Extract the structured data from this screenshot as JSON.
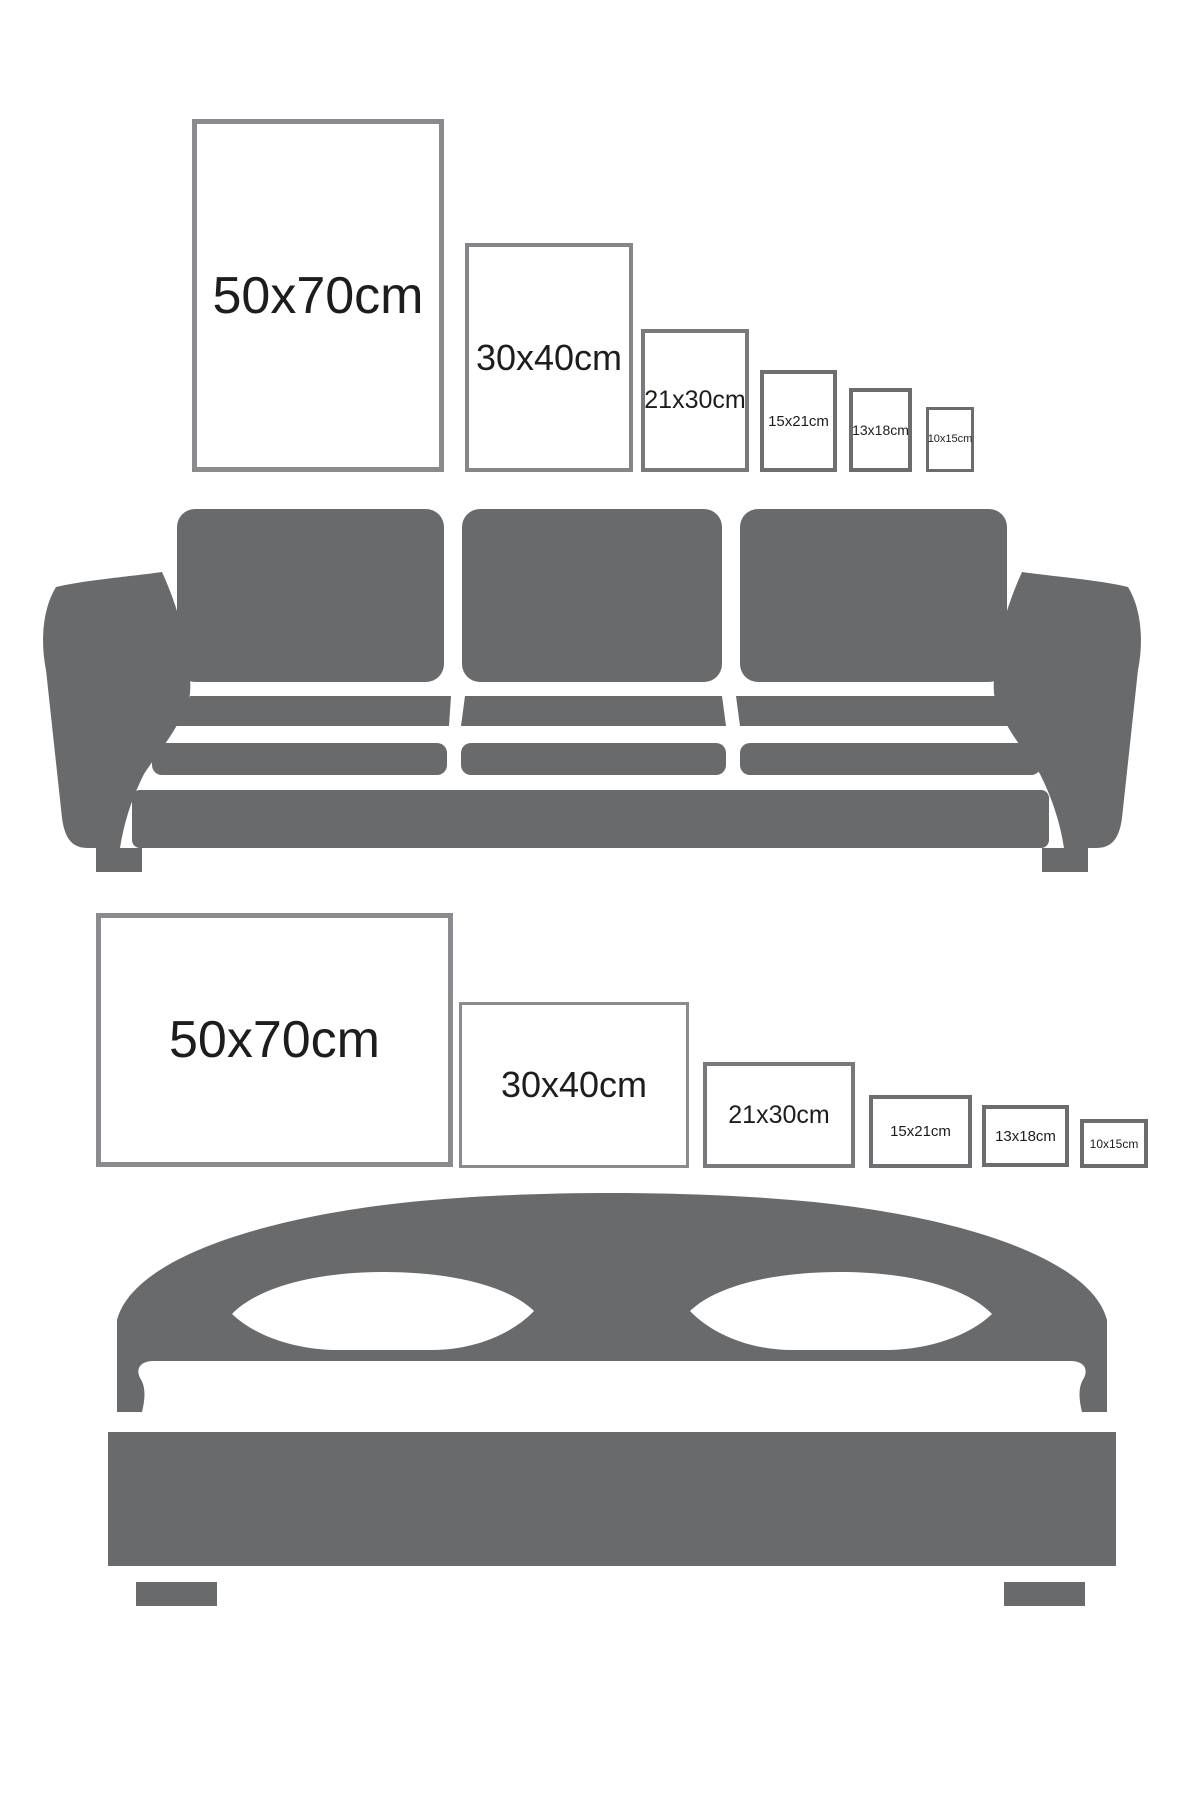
{
  "title": "poster-size-comparison-guide",
  "colors": {
    "background": "#ffffff",
    "furniture_gray": "#686a6c",
    "label_text": "#1d1d1b"
  },
  "top_section": {
    "furniture_icon": "sofa-icon",
    "orientation": "portrait",
    "frames": [
      {
        "label": "50x70cm",
        "x": 192,
        "y": 119,
        "w": 252,
        "h": 353,
        "border": 5,
        "border_color": "#8a8b8e",
        "font": 52
      },
      {
        "label": "30x40cm",
        "x": 465,
        "y": 243,
        "w": 168,
        "h": 229,
        "border": 4,
        "border_color": "#85868a",
        "font": 36
      },
      {
        "label": "21x30cm",
        "x": 641,
        "y": 329,
        "w": 108,
        "h": 143,
        "border": 4,
        "border_color": "#78797c",
        "font": 25
      },
      {
        "label": "15x21cm",
        "x": 760,
        "y": 370,
        "w": 77,
        "h": 102,
        "border": 4,
        "border_color": "#6e6f72",
        "font": 15
      },
      {
        "label": "13x18cm",
        "x": 849,
        "y": 388,
        "w": 63,
        "h": 84,
        "border": 4,
        "border_color": "#6b6c6e",
        "font": 14
      },
      {
        "label": "10x15cm",
        "x": 926,
        "y": 407,
        "w": 48,
        "h": 65,
        "border": 3,
        "border_color": "#6b6c6e",
        "font": 11
      }
    ]
  },
  "bottom_section": {
    "furniture_icon": "bed-icon",
    "orientation": "landscape",
    "frames": [
      {
        "label": "50x70cm",
        "x": 96,
        "y": 913,
        "w": 357,
        "h": 254,
        "border": 5,
        "border_color": "#8a8b8e",
        "font": 52
      },
      {
        "label": "30x40cm",
        "x": 459,
        "y": 1002,
        "w": 230,
        "h": 166,
        "border": 3,
        "border_color": "#8a8b8e",
        "font": 36
      },
      {
        "label": "21x30cm",
        "x": 703,
        "y": 1062,
        "w": 152,
        "h": 106,
        "border": 4,
        "border_color": "#78797c",
        "font": 25
      },
      {
        "label": "15x21cm",
        "x": 869,
        "y": 1095,
        "w": 103,
        "h": 73,
        "border": 4,
        "border_color": "#6e6f72",
        "font": 15
      },
      {
        "label": "13x18cm",
        "x": 982,
        "y": 1105,
        "w": 87,
        "h": 62,
        "border": 4,
        "border_color": "#6b6c6e",
        "font": 15
      },
      {
        "label": "10x15cm",
        "x": 1080,
        "y": 1119,
        "w": 68,
        "h": 49,
        "border": 4,
        "border_color": "#6b6c6e",
        "font": 12
      }
    ]
  }
}
